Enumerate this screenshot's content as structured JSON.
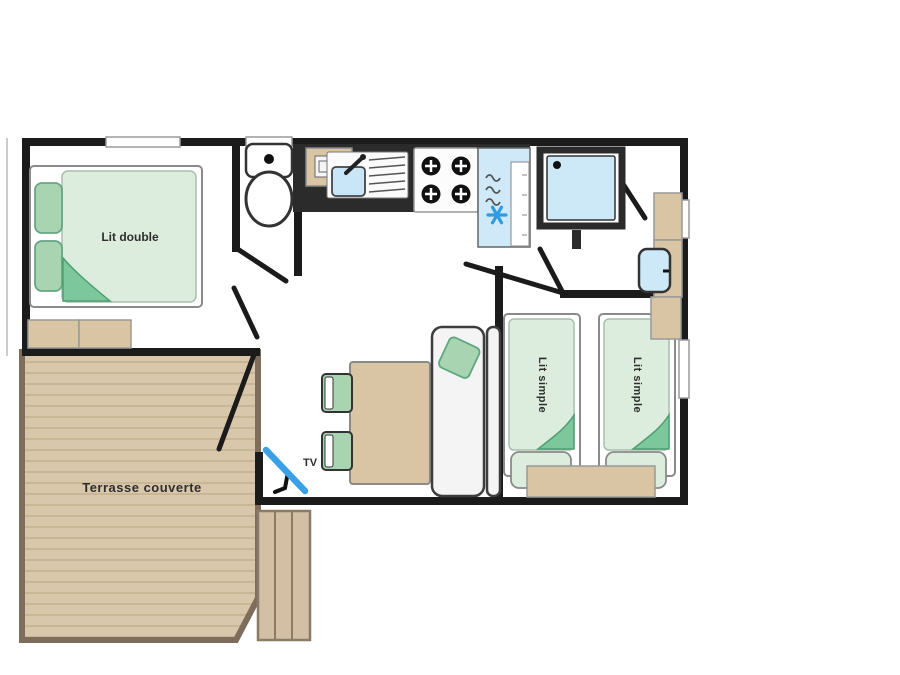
{
  "plan": {
    "type": "floorplan",
    "labels": {
      "bedroom_double": "Lit double",
      "bedroom_single_1": "Lit simple",
      "bedroom_single_2": "Lit simple",
      "terrace": "Terrasse couverte",
      "tv": "TV"
    },
    "colors": {
      "wall": "#1b1b1b",
      "counter_dark": "#2b2b2b",
      "bed_linen": "#dcecdd",
      "pillow_green": "#a9d4b2",
      "fold_green": "#7cc79c",
      "furniture_beige": "#d9c4a3",
      "terrace_deck": "#d8c7ab",
      "terrace_plank_line": "#c9b697",
      "terrace_border": "#7d6d5a",
      "water_blue": "#cde9f8",
      "accent_blue": "#3aa0e8",
      "sofa_grey": "#f4f4f4",
      "background": "#ffffff"
    },
    "icons": [
      "toilet-icon",
      "microwave-icon",
      "kitchen-sink-icon",
      "stove-icon",
      "fridge-icon",
      "snowflake-icon",
      "shower-icon",
      "washbasin-icon",
      "tv-icon"
    ]
  }
}
